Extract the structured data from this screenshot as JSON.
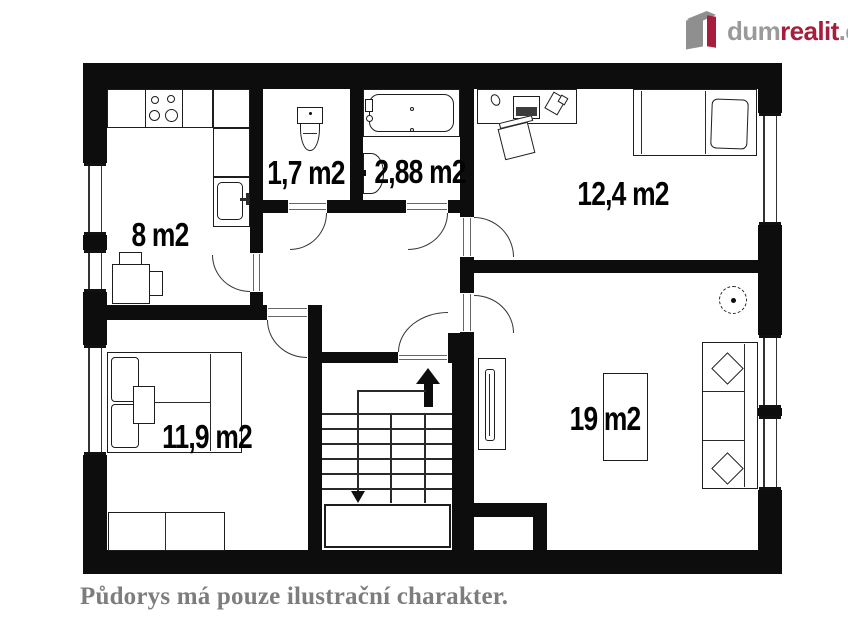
{
  "logo": {
    "text_gray_1": "dum",
    "text_red": "realit",
    "text_gray_2": ".cz",
    "brand_red": "#a51e3c",
    "brand_gray": "#9a9a9a"
  },
  "rooms": {
    "kitchen": {
      "label": "8 m2"
    },
    "wc": {
      "label": "1,7 m2"
    },
    "bathroom": {
      "label": "2,88 m2"
    },
    "bedroom_upper": {
      "label": "12,4 m2"
    },
    "bedroom_lower": {
      "label": "11,9 m2"
    },
    "living_room": {
      "label": "19 m2"
    }
  },
  "caption": "Půdorys má pouze ilustrační charakter."
}
